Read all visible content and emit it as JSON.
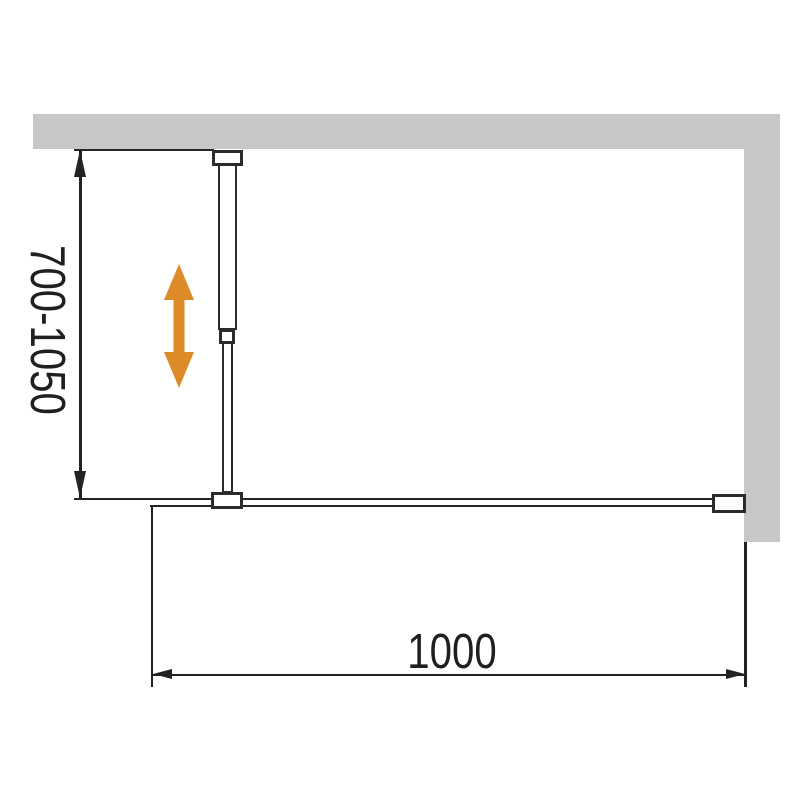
{
  "diagram": {
    "labels": {
      "height_range": "700-1050",
      "width": "1000"
    },
    "colors": {
      "wall_fill": "#c7c7c7",
      "outline": "#2b2b2b",
      "dimension": "#222222",
      "adjust_arrow": "#dd8b28",
      "background": "#ffffff"
    }
  }
}
